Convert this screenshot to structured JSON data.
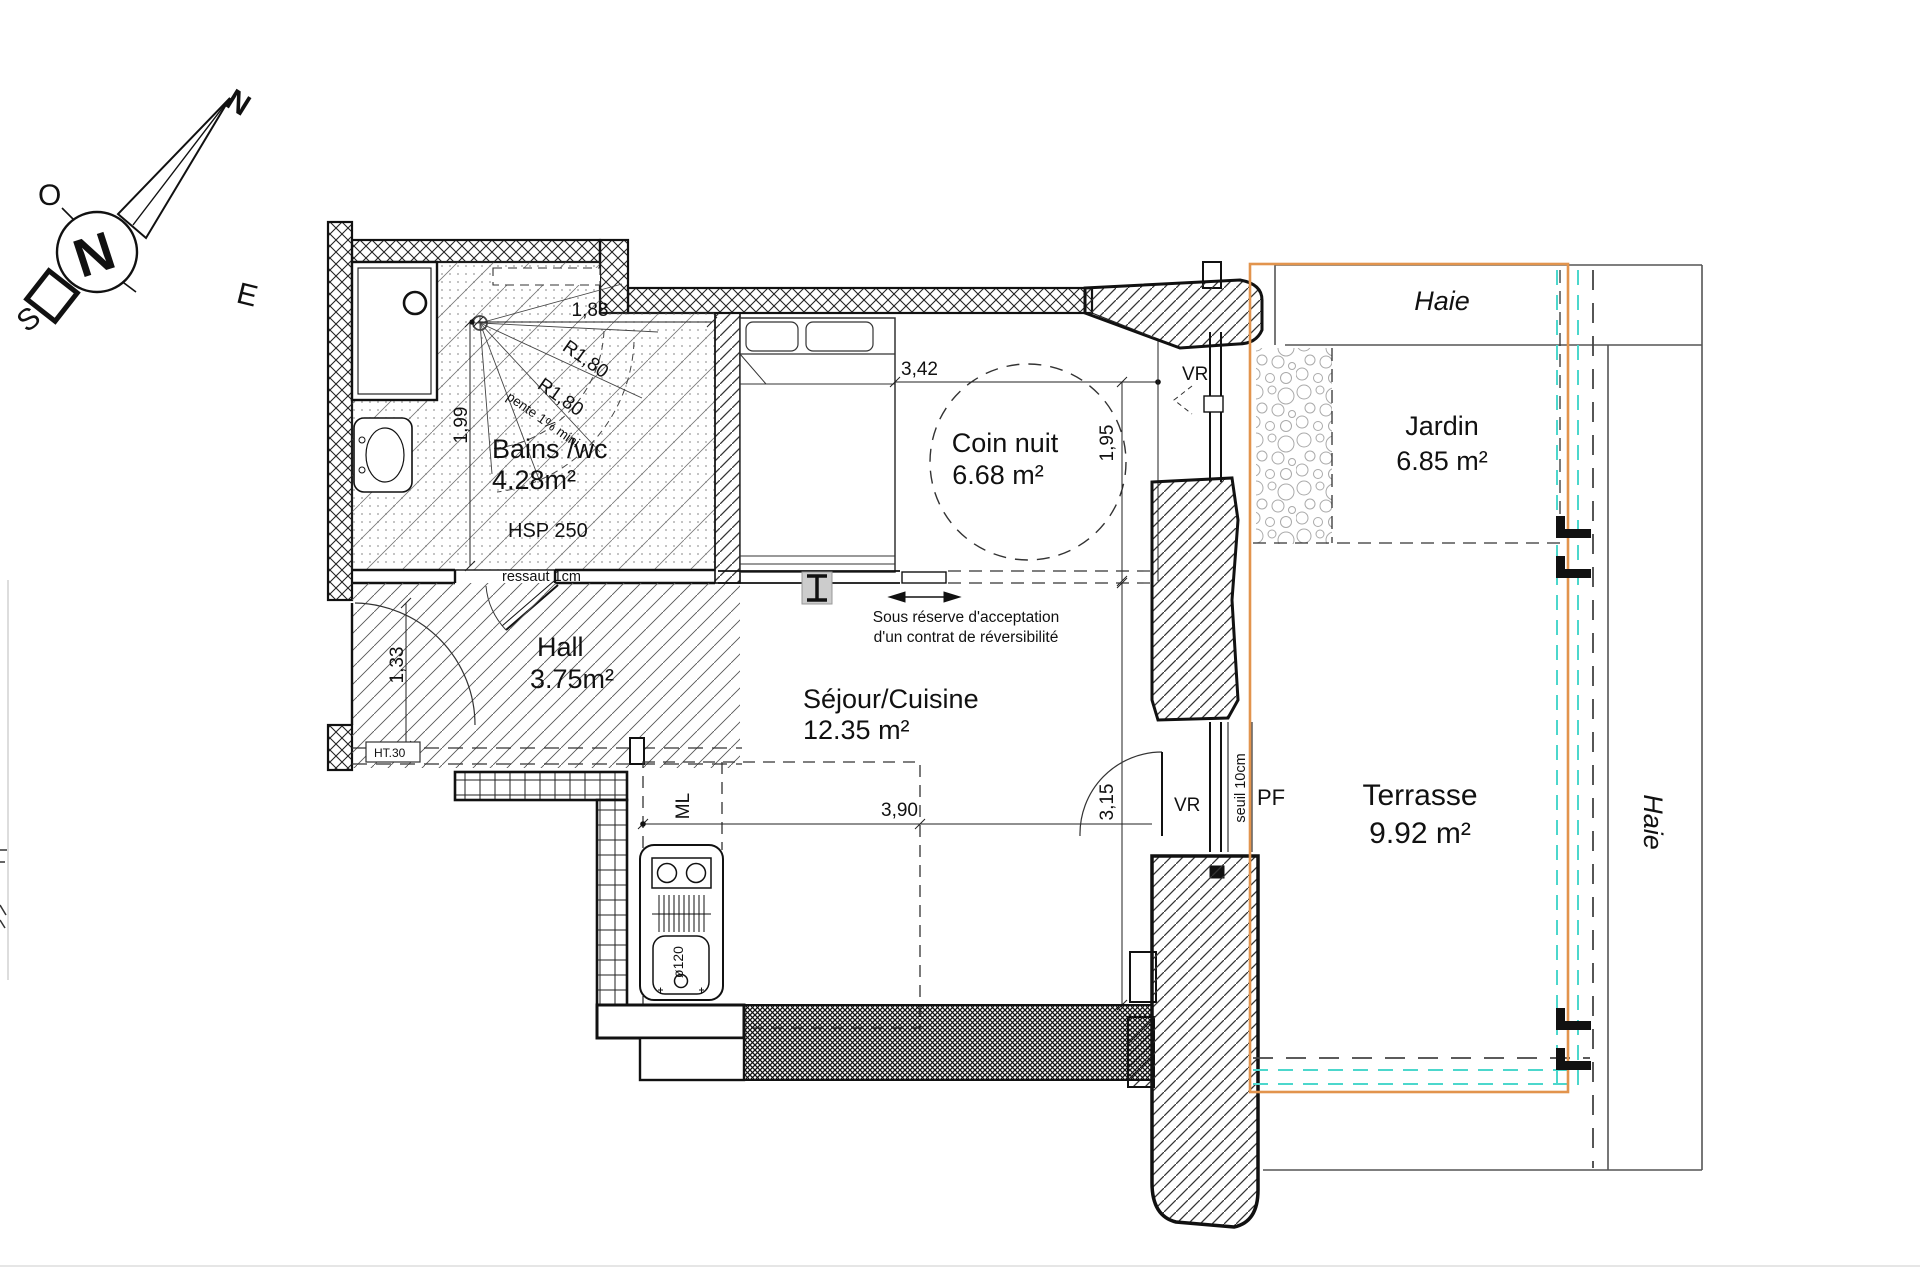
{
  "compass": {
    "n": "N",
    "o": "O",
    "e": "E",
    "s": "S",
    "hub": "N"
  },
  "bathroom": {
    "name": "Bains /wc",
    "area": "4.28m²",
    "ceiling": "HSP 250",
    "step": "ressaut 1cm",
    "slope": "pente 1% mini",
    "dim_width": "1,88",
    "dim_height": "1,99",
    "radius1": "R1,80",
    "radius2": "R1,80"
  },
  "bedroom": {
    "name": "Coin nuit",
    "area": "6.68 m²",
    "dim_width": "3,42",
    "dim_height": "1,95",
    "window": "VR"
  },
  "hall": {
    "name": "Hall",
    "area": "3.75m²",
    "dim": "1,33",
    "ht": "HT.30"
  },
  "living": {
    "name": "Séjour/Cuisine",
    "area": "12.35 m²",
    "dim_width": "3,90",
    "dim_height": "3,15",
    "washer": "ML",
    "sink_diameter": "ø120",
    "window": "VR",
    "door": "PF",
    "threshold": "seuil 10cm",
    "note_line1": "Sous réserve d'acceptation",
    "note_line2": "d'un contrat de réversibilité"
  },
  "exterior": {
    "garden_name": "Jardin",
    "garden_area": "6.85 m²",
    "terrace_name": "Terrasse",
    "terrace_area": "9.92 m²",
    "hedge_top": "Haie",
    "hedge_right": "Haie"
  },
  "colors": {
    "property_line": "#e2944d",
    "limit_line": "#4cd7cc"
  }
}
